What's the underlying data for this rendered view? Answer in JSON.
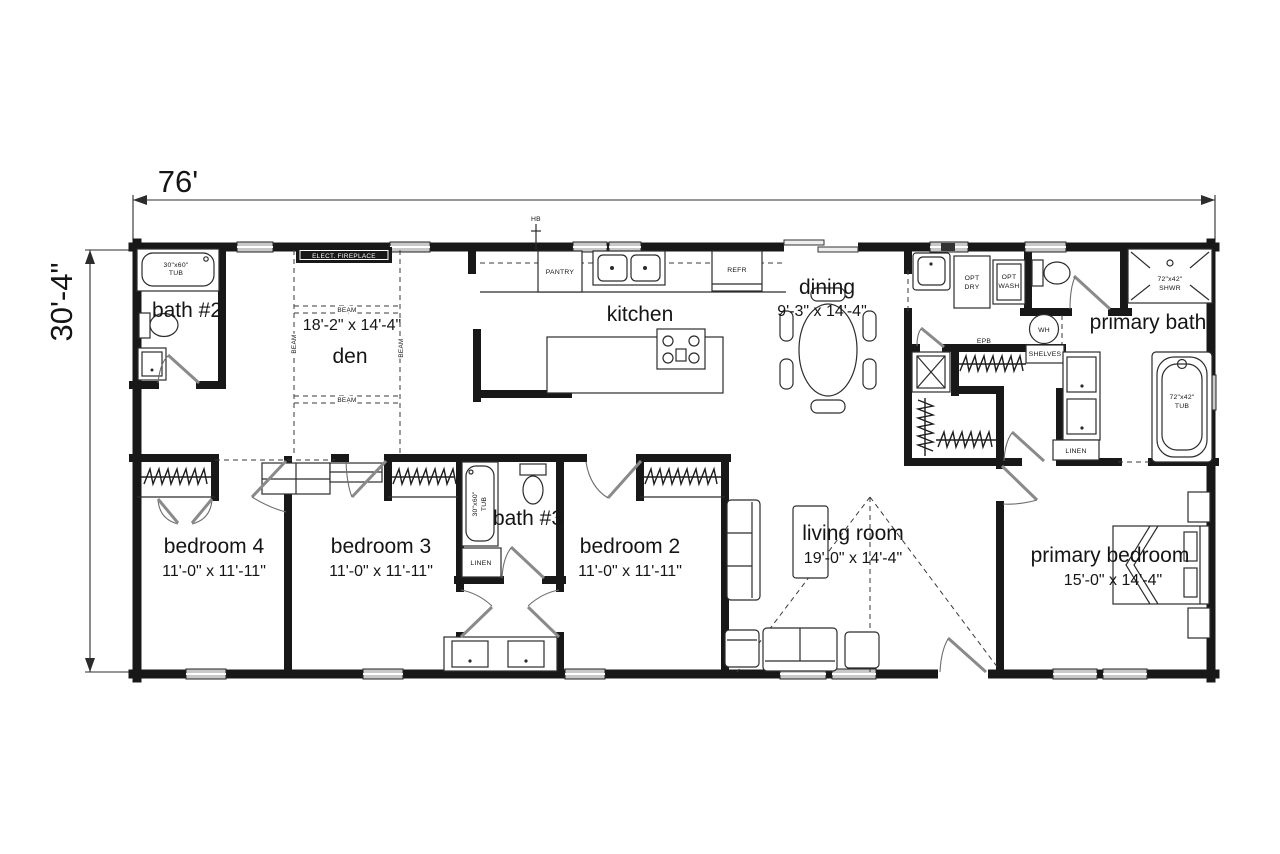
{
  "plan": {
    "overall_width": "76'",
    "overall_height": "30'-4\""
  },
  "rooms": {
    "bath2": {
      "name": "bath #2"
    },
    "den": {
      "name": "den",
      "size": "18'-2\" x 14'-4\""
    },
    "kitchen": {
      "name": "kitchen"
    },
    "dining": {
      "name": "dining",
      "size": "9'-3\" x 14'-4\""
    },
    "primary_bath": {
      "name": "primary bath"
    },
    "bedroom4": {
      "name": "bedroom 4",
      "size": "11'-0\" x 11'-11\""
    },
    "bedroom3": {
      "name": "bedroom 3",
      "size": "11'-0\" x 11'-11\""
    },
    "bath3": {
      "name": "bath #3"
    },
    "bedroom2": {
      "name": "bedroom 2",
      "size": "11'-0\" x 11'-11\""
    },
    "living": {
      "name": "living room",
      "size": "19'-0\" x 14'-4\""
    },
    "primary_bedroom": {
      "name": "primary bedroom",
      "size": "15'-0\" x 14'-4\""
    }
  },
  "fixtures": {
    "tub_30x60": [
      "30\"x60\"",
      "TUB"
    ],
    "shower_72x42": [
      "72\"x42\"",
      "SHWR"
    ],
    "tub_72x42": [
      "72\"x42\"",
      "TUB"
    ],
    "pantry": "PANTRY",
    "refrigerator": "REFR",
    "electric_fireplace": "ELECT. FIREPLACE",
    "beam": "BEAM",
    "hose_bib": "HB",
    "opt_dryer": [
      "OPT",
      "DRY"
    ],
    "opt_washer": [
      "OPT",
      "WASH"
    ],
    "water_heater": "WH",
    "electric_panel": "EPB",
    "shelves": "SHELVES",
    "linen": "LINEN"
  },
  "colors": {
    "wall": "#181818",
    "window": "#c9c9c9",
    "line": "#2c2c2c"
  }
}
